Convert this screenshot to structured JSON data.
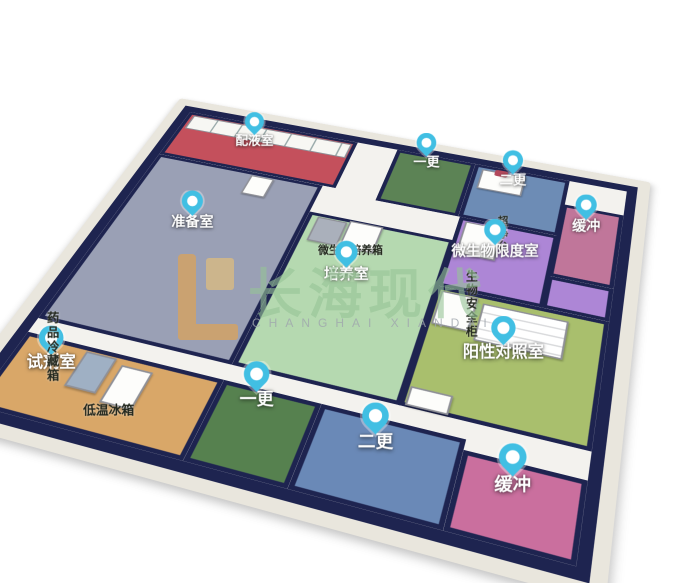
{
  "title": "微生物实验室三维平面布局图",
  "palette": {
    "wall": "#e9e6dd",
    "wall_edge": "#1e2450",
    "floor": "#f3f2ee",
    "pin_accent": "#41bfe3",
    "background": "#ffffff"
  },
  "icons": {
    "room_marker": "map-pin-icon"
  },
  "rooms": [
    {
      "id": "peiyeshi",
      "label": "配液室",
      "color": "#c4505c"
    },
    {
      "id": "zhunbeishi",
      "label": "准备室",
      "color": "#9aa0b5"
    },
    {
      "id": "peiyangshi",
      "label": "培养室",
      "color": "#b5d9b0"
    },
    {
      "id": "yigeng-top",
      "label": "一更",
      "color": "#5c8355"
    },
    {
      "id": "ergeng-top",
      "label": "二更",
      "color": "#6d8cb5"
    },
    {
      "id": "huanchong-right",
      "label": "缓冲",
      "color": "#c0769a"
    },
    {
      "id": "weishengwu-xiandushi",
      "label": "微生物限度室",
      "color": "#ad86d6"
    },
    {
      "id": "yangxing-duizhaoshi",
      "label": "阳性对照室",
      "color": "#a9bf6d"
    },
    {
      "id": "yigeng-bottom",
      "label": "一更",
      "color": "#56814f"
    },
    {
      "id": "ergeng-bottom",
      "label": "二更",
      "color": "#6a89b7"
    },
    {
      "id": "huanchong-bottom",
      "label": "缓冲",
      "color": "#ca6f9e"
    },
    {
      "id": "shijishi",
      "label": "试剂室",
      "color": "#d9a768"
    }
  ],
  "equipment": [
    {
      "id": "incubator",
      "label": "微生物培养箱"
    },
    {
      "id": "clean-bench",
      "label": "超净台"
    },
    {
      "id": "biosafety-cabinet",
      "label": "生物安全柜"
    },
    {
      "id": "medicine-fridge",
      "label": "药品冷藏箱"
    },
    {
      "id": "low-temp-freezer",
      "label": "低温冰箱"
    }
  ],
  "watermark": {
    "cn": "长海现代",
    "en": "CHANGHAI XIANDAI",
    "cn_color": "#96c496",
    "en_color": "#9fa5ad",
    "logo_color": "#f2a53a"
  }
}
